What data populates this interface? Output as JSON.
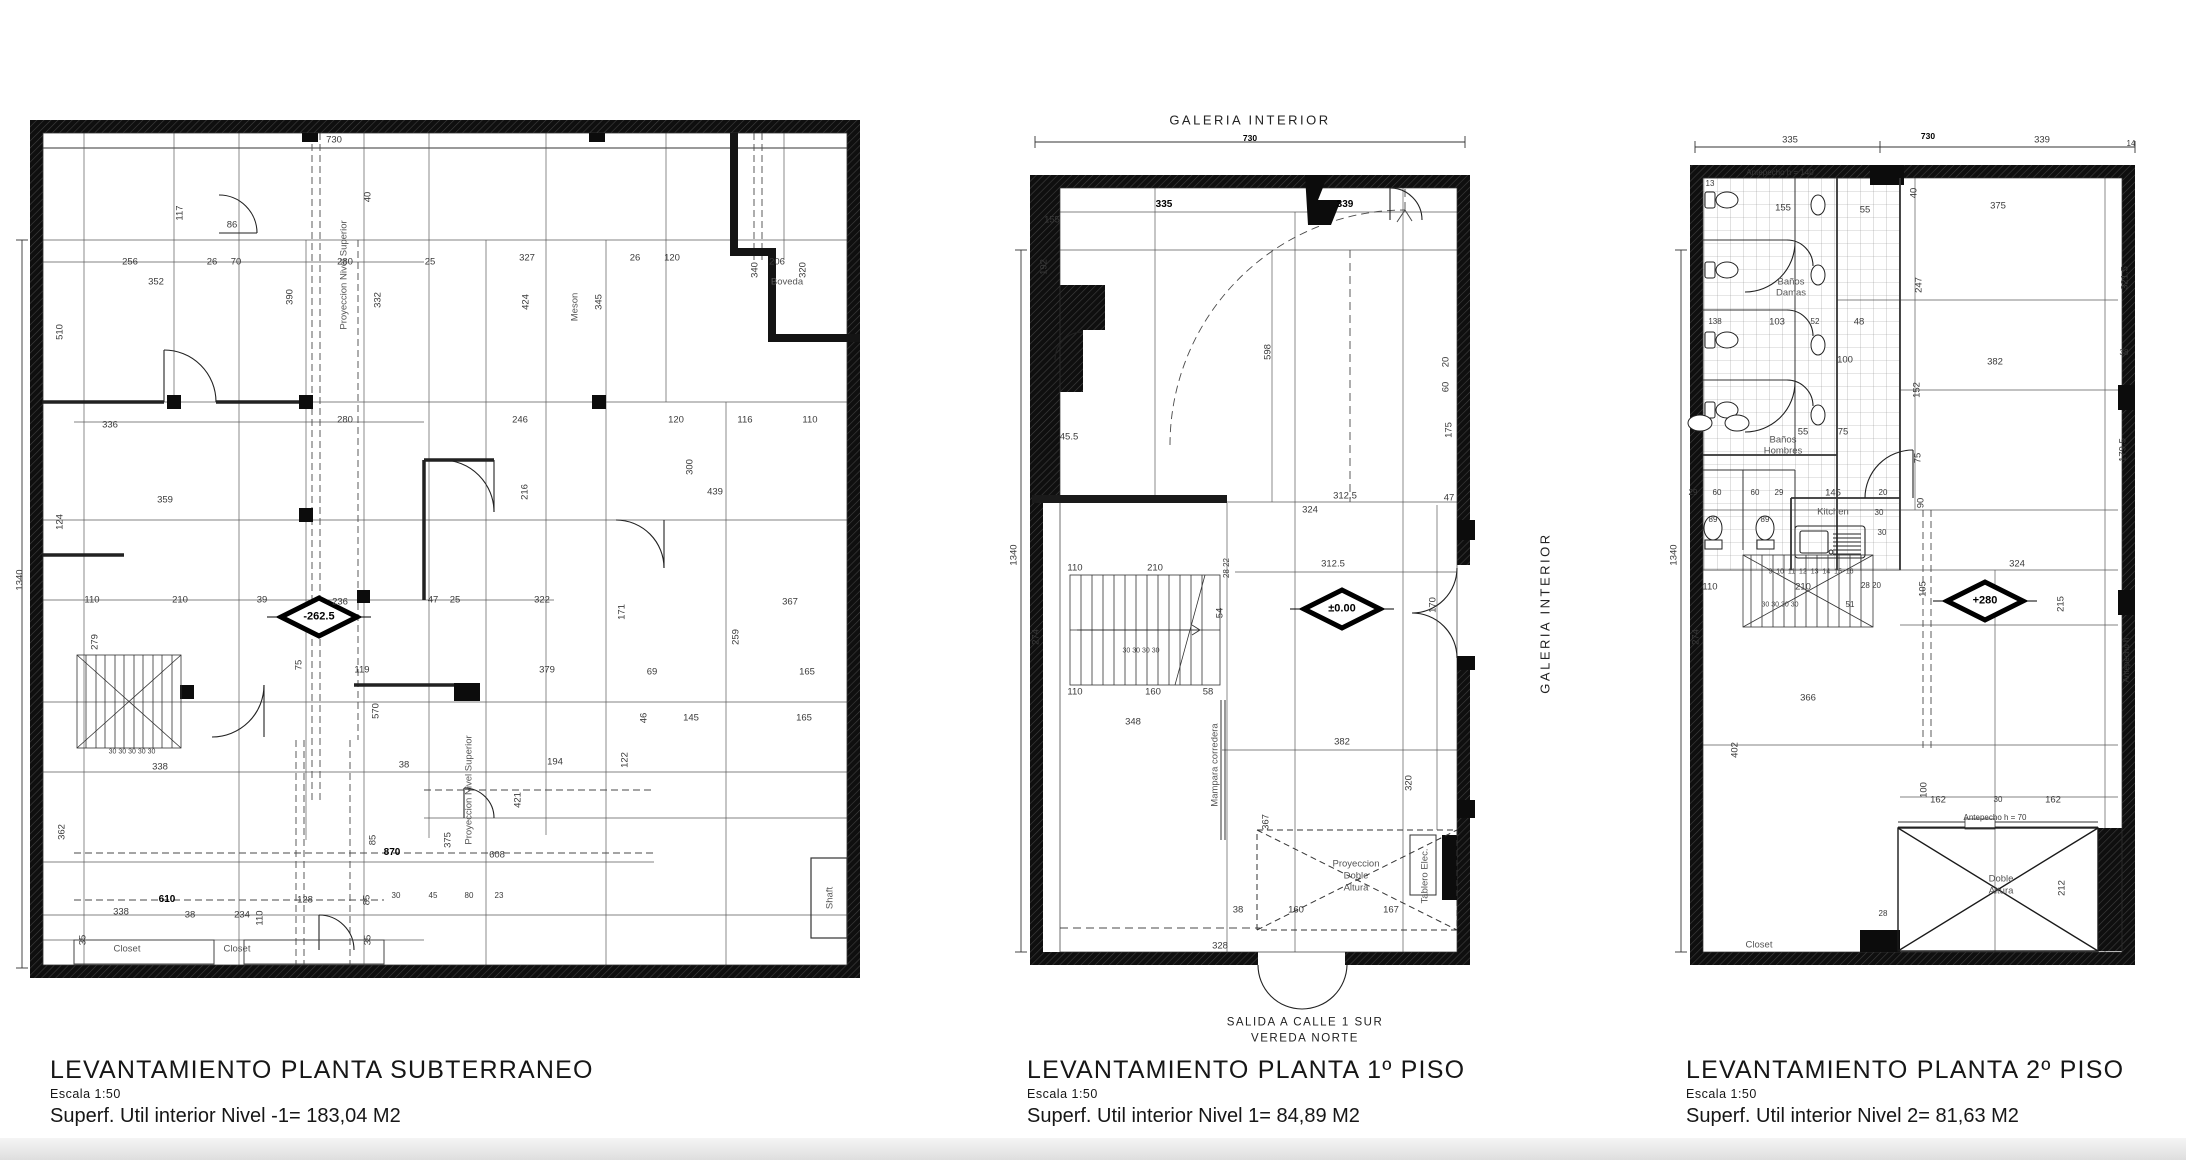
{
  "sheet": {
    "background": "#ffffff",
    "line_color": "#333333",
    "wall_color": "#0f0f0f"
  },
  "plans": [
    {
      "id": "p1",
      "title": "LEVANTAMIENTO PLANTA SUBTERRANEO",
      "scale_label": "Escala 1:50",
      "area_label": "Superf. Util interior Nivel -1= 183,04 M2",
      "level_marker": "-262.5",
      "labels": [
        {
          "t": "730",
          "x": 320,
          "y": 40
        },
        {
          "t": "1340",
          "x": 6,
          "y": 480,
          "r": 1
        },
        {
          "t": "117",
          "x": 166,
          "y": 113,
          "r": 1
        },
        {
          "t": "86",
          "x": 218,
          "y": 125
        },
        {
          "t": "256",
          "x": 116,
          "y": 162
        },
        {
          "t": "26",
          "x": 198,
          "y": 162
        },
        {
          "t": "70",
          "x": 222,
          "y": 162
        },
        {
          "t": "280",
          "x": 331,
          "y": 162
        },
        {
          "t": "25",
          "x": 416,
          "y": 162
        },
        {
          "t": "327",
          "x": 513,
          "y": 158
        },
        {
          "t": "26",
          "x": 621,
          "y": 158
        },
        {
          "t": "120",
          "x": 658,
          "y": 158
        },
        {
          "t": "206",
          "x": 763,
          "y": 162
        },
        {
          "t": "352",
          "x": 142,
          "y": 182
        },
        {
          "t": "Boveda",
          "x": 773,
          "y": 182,
          "c": "room"
        },
        {
          "t": "40",
          "x": 354,
          "y": 97,
          "r": 1
        },
        {
          "t": "390",
          "x": 276,
          "y": 197,
          "r": 1
        },
        {
          "t": "332",
          "x": 364,
          "y": 200,
          "r": 1
        },
        {
          "t": "424",
          "x": 512,
          "y": 202,
          "r": 1
        },
        {
          "t": "Meson",
          "x": 561,
          "y": 207,
          "r": 1,
          "c": "room"
        },
        {
          "t": "345",
          "x": 585,
          "y": 202,
          "r": 1
        },
        {
          "t": "340",
          "x": 741,
          "y": 170,
          "r": 1
        },
        {
          "t": "320",
          "x": 789,
          "y": 170,
          "r": 1
        },
        {
          "t": "510",
          "x": 46,
          "y": 232,
          "r": 1
        },
        {
          "t": "Proyeccion Nivel Superior",
          "x": 330,
          "y": 175,
          "r": 1,
          "c": "room"
        },
        {
          "t": "336",
          "x": 96,
          "y": 325
        },
        {
          "t": "280",
          "x": 331,
          "y": 320
        },
        {
          "t": "246",
          "x": 506,
          "y": 320
        },
        {
          "t": "120",
          "x": 662,
          "y": 320
        },
        {
          "t": "116",
          "x": 731,
          "y": 320
        },
        {
          "t": "110",
          "x": 796,
          "y": 320
        },
        {
          "t": "359",
          "x": 151,
          "y": 400
        },
        {
          "t": "216",
          "x": 511,
          "y": 392,
          "r": 1
        },
        {
          "t": "300",
          "x": 676,
          "y": 367,
          "r": 1
        },
        {
          "t": "439",
          "x": 701,
          "y": 392
        },
        {
          "t": "124",
          "x": 46,
          "y": 422,
          "r": 1
        },
        {
          "t": "110",
          "x": 78,
          "y": 500
        },
        {
          "t": "210",
          "x": 166,
          "y": 500
        },
        {
          "t": "39",
          "x": 248,
          "y": 500
        },
        {
          "t": "236",
          "x": 326,
          "y": 502
        },
        {
          "t": "47",
          "x": 419,
          "y": 500
        },
        {
          "t": "25",
          "x": 441,
          "y": 500
        },
        {
          "t": "322",
          "x": 528,
          "y": 500
        },
        {
          "t": "171",
          "x": 608,
          "y": 512,
          "r": 1
        },
        {
          "t": "367",
          "x": 776,
          "y": 502
        },
        {
          "t": "-262.5",
          "x": 305,
          "y": 517,
          "c": "lvl"
        },
        {
          "t": "279",
          "x": 81,
          "y": 542,
          "r": 1
        },
        {
          "t": "75",
          "x": 285,
          "y": 565,
          "r": 1
        },
        {
          "t": "119",
          "x": 348,
          "y": 570
        },
        {
          "t": "379",
          "x": 533,
          "y": 570
        },
        {
          "t": "69",
          "x": 638,
          "y": 572
        },
        {
          "t": "165",
          "x": 793,
          "y": 572
        },
        {
          "t": "259",
          "x": 722,
          "y": 537,
          "r": 1
        },
        {
          "t": "30 30 30 30 30",
          "x": 118,
          "y": 652,
          "c": "sm"
        },
        {
          "t": "570",
          "x": 362,
          "y": 611,
          "r": 1
        },
        {
          "t": "46",
          "x": 630,
          "y": 618,
          "r": 1
        },
        {
          "t": "145",
          "x": 677,
          "y": 618
        },
        {
          "t": "165",
          "x": 790,
          "y": 618
        },
        {
          "t": "338",
          "x": 146,
          "y": 667
        },
        {
          "t": "38",
          "x": 390,
          "y": 665
        },
        {
          "t": "194",
          "x": 541,
          "y": 662
        },
        {
          "t": "122",
          "x": 611,
          "y": 660,
          "r": 1
        },
        {
          "t": "Proyeccion Nivel Superior",
          "x": 455,
          "y": 690,
          "r": 1,
          "c": "room"
        },
        {
          "t": "362",
          "x": 48,
          "y": 732,
          "r": 1
        },
        {
          "t": "85",
          "x": 359,
          "y": 740,
          "r": 1
        },
        {
          "t": "375",
          "x": 434,
          "y": 740,
          "r": 1
        },
        {
          "t": "870",
          "x": 378,
          "y": 753,
          "c": "b"
        },
        {
          "t": "608",
          "x": 483,
          "y": 755
        },
        {
          "t": "421",
          "x": 504,
          "y": 700,
          "r": 1
        },
        {
          "t": "30",
          "x": 382,
          "y": 796,
          "c": "sm8"
        },
        {
          "t": "45",
          "x": 419,
          "y": 796,
          "c": "sm8"
        },
        {
          "t": "80",
          "x": 455,
          "y": 796,
          "c": "sm8"
        },
        {
          "t": "23",
          "x": 485,
          "y": 796,
          "c": "sm8"
        },
        {
          "t": "610",
          "x": 153,
          "y": 800,
          "c": "b"
        },
        {
          "t": "128",
          "x": 291,
          "y": 800
        },
        {
          "t": "338",
          "x": 107,
          "y": 812
        },
        {
          "t": "38",
          "x": 176,
          "y": 815
        },
        {
          "t": "234",
          "x": 228,
          "y": 815
        },
        {
          "t": "110",
          "x": 246,
          "y": 818,
          "r": 1
        },
        {
          "t": "35",
          "x": 69,
          "y": 840,
          "r": 1
        },
        {
          "t": "85",
          "x": 353,
          "y": 800,
          "r": 1
        },
        {
          "t": "35",
          "x": 354,
          "y": 840,
          "r": 1
        },
        {
          "t": "Closet",
          "x": 113,
          "y": 849,
          "c": "room"
        },
        {
          "t": "Closet",
          "x": 223,
          "y": 849,
          "c": "room"
        },
        {
          "t": "Shaft",
          "x": 816,
          "y": 798,
          "r": 1,
          "c": "room"
        }
      ]
    },
    {
      "id": "p2",
      "title": "LEVANTAMIENTO PLANTA 1º PISO",
      "scale_label": "Escala 1:50",
      "area_label": "Superf. Util interior Nivel 1= 84,89 M2",
      "level_marker": "±0.00",
      "labels": [
        {
          "t": "GALERIA INTERIOR",
          "x": 245,
          "y": 20,
          "c": "big"
        },
        {
          "t": "730",
          "x": 245,
          "y": 38,
          "c": "b2"
        },
        {
          "t": "335",
          "x": 159,
          "y": 105,
          "c": "b"
        },
        {
          "t": "339",
          "x": 340,
          "y": 105,
          "c": "b"
        },
        {
          "t": "155",
          "x": 47,
          "y": 120
        },
        {
          "t": "192",
          "x": 39,
          "y": 167,
          "r": 1
        },
        {
          "t": "598",
          "x": 263,
          "y": 252,
          "r": 1
        },
        {
          "t": "20",
          "x": 441,
          "y": 262,
          "r": 1
        },
        {
          "t": "60",
          "x": 441,
          "y": 287,
          "r": 1
        },
        {
          "t": "175",
          "x": 444,
          "y": 330,
          "r": 1
        },
        {
          "t": "45.5",
          "x": 64,
          "y": 337
        },
        {
          "t": "312.5",
          "x": 340,
          "y": 396
        },
        {
          "t": "324",
          "x": 305,
          "y": 410
        },
        {
          "t": "47",
          "x": 444,
          "y": 398
        },
        {
          "t": "312.5",
          "x": 328,
          "y": 464
        },
        {
          "t": "110",
          "x": 70,
          "y": 468
        },
        {
          "t": "210",
          "x": 150,
          "y": 468
        },
        {
          "t": "28 22",
          "x": 222,
          "y": 468,
          "r": 1,
          "c": "sm8"
        },
        {
          "t": "30 30 30 30",
          "x": 136,
          "y": 551,
          "c": "sm"
        },
        {
          "t": "54",
          "x": 215,
          "y": 513,
          "r": 1
        },
        {
          "t": "±0.00",
          "x": 337,
          "y": 509,
          "c": "lvl"
        },
        {
          "t": "170",
          "x": 428,
          "y": 505,
          "r": 1
        },
        {
          "t": "110",
          "x": 70,
          "y": 592
        },
        {
          "t": "160",
          "x": 148,
          "y": 592
        },
        {
          "t": "58",
          "x": 203,
          "y": 592
        },
        {
          "t": "348",
          "x": 128,
          "y": 622
        },
        {
          "t": "GALERIA INTERIOR",
          "x": 540,
          "y": 513,
          "r": 1,
          "c": "big"
        },
        {
          "t": "Mampara corredera",
          "x": 210,
          "y": 665,
          "r": 1,
          "c": "room"
        },
        {
          "t": "382",
          "x": 337,
          "y": 642
        },
        {
          "t": "320",
          "x": 404,
          "y": 683,
          "r": 1
        },
        {
          "t": "367",
          "x": 261,
          "y": 722,
          "r": 1
        },
        {
          "t": "274",
          "x": 31,
          "y": 537,
          "r": 1
        },
        {
          "t": "1340",
          "x": 9,
          "y": 455,
          "r": 1
        },
        {
          "t": "Proyeccion",
          "x": 351,
          "y": 764,
          "c": "room"
        },
        {
          "t": "Doble",
          "x": 351,
          "y": 776,
          "c": "room"
        },
        {
          "t": "Altura",
          "x": 351,
          "y": 788,
          "c": "room"
        },
        {
          "t": "Tablero Elec.",
          "x": 420,
          "y": 776,
          "r": 1,
          "c": "room"
        },
        {
          "t": "38",
          "x": 233,
          "y": 810
        },
        {
          "t": "160",
          "x": 291,
          "y": 810
        },
        {
          "t": "167",
          "x": 386,
          "y": 810
        },
        {
          "t": "328",
          "x": 215,
          "y": 846
        },
        {
          "t": "SALIDA A CALLE 1 SUR",
          "x": 300,
          "y": 923,
          "c": "big2"
        },
        {
          "t": "VEREDA NORTE",
          "x": 300,
          "y": 939,
          "c": "big2"
        }
      ]
    },
    {
      "id": "p3",
      "title": "LEVANTAMIENTO PLANTA 2º PISO",
      "scale_label": "Escala 1:50",
      "area_label": "Superf. Util interior Nivel 2= 81,63 M2",
      "level_marker": "+280",
      "labels": [
        {
          "t": "335",
          "x": 125,
          "y": 40
        },
        {
          "t": "730",
          "x": 263,
          "y": 36,
          "c": "b2"
        },
        {
          "t": "339",
          "x": 377,
          "y": 40
        },
        {
          "t": "14",
          "x": 466,
          "y": 44,
          "c": "sm8"
        },
        {
          "t": "Antepecho h = 140",
          "x": 115,
          "y": 73,
          "c": "sm8"
        },
        {
          "t": "13",
          "x": 45,
          "y": 84,
          "c": "sm8"
        },
        {
          "t": "155",
          "x": 118,
          "y": 108
        },
        {
          "t": "55",
          "x": 200,
          "y": 110
        },
        {
          "t": "40",
          "x": 249,
          "y": 93,
          "r": 1
        },
        {
          "t": "375",
          "x": 333,
          "y": 106
        },
        {
          "t": "247",
          "x": 254,
          "y": 185,
          "r": 1
        },
        {
          "t": "321.5",
          "x": 460,
          "y": 178,
          "r": 1
        },
        {
          "t": "Baños",
          "x": 126,
          "y": 182,
          "c": "room"
        },
        {
          "t": "Damas",
          "x": 126,
          "y": 193,
          "c": "room"
        },
        {
          "t": "138",
          "x": 50,
          "y": 222,
          "c": "sm8"
        },
        {
          "t": "103",
          "x": 112,
          "y": 222
        },
        {
          "t": "52",
          "x": 150,
          "y": 222,
          "c": "sm8"
        },
        {
          "t": "48",
          "x": 194,
          "y": 222
        },
        {
          "t": "100",
          "x": 180,
          "y": 260
        },
        {
          "t": "152",
          "x": 252,
          "y": 290,
          "r": 1
        },
        {
          "t": "382",
          "x": 330,
          "y": 262
        },
        {
          "t": "38",
          "x": 459,
          "y": 253,
          "c": "sm8"
        },
        {
          "t": "179.5",
          "x": 458,
          "y": 350,
          "r": 1
        },
        {
          "t": "Baños",
          "x": 118,
          "y": 340,
          "c": "room"
        },
        {
          "t": "Hombres",
          "x": 118,
          "y": 351,
          "c": "room"
        },
        {
          "t": "55",
          "x": 138,
          "y": 332
        },
        {
          "t": "75",
          "x": 178,
          "y": 332
        },
        {
          "t": "75",
          "x": 253,
          "y": 358,
          "r": 1
        },
        {
          "t": "29",
          "x": 28,
          "y": 393,
          "c": "sm8"
        },
        {
          "t": "60",
          "x": 52,
          "y": 393,
          "c": "sm8"
        },
        {
          "t": "60",
          "x": 90,
          "y": 393,
          "c": "sm8"
        },
        {
          "t": "29",
          "x": 114,
          "y": 393,
          "c": "sm8"
        },
        {
          "t": "145",
          "x": 168,
          "y": 393
        },
        {
          "t": "20",
          "x": 218,
          "y": 393,
          "c": "sm8"
        },
        {
          "t": "90",
          "x": 256,
          "y": 403,
          "r": 1
        },
        {
          "t": "Kitchen",
          "x": 168,
          "y": 412,
          "c": "room"
        },
        {
          "t": "30",
          "x": 214,
          "y": 413,
          "c": "sm8"
        },
        {
          "t": "30",
          "x": 217,
          "y": 433,
          "c": "sm8"
        },
        {
          "t": "89",
          "x": 48,
          "y": 420,
          "c": "sm8"
        },
        {
          "t": "89",
          "x": 100,
          "y": 420,
          "c": "sm8"
        },
        {
          "t": "9  10  11  12  13  14  15  16",
          "x": 146,
          "y": 472,
          "c": "sm"
        },
        {
          "t": "110",
          "x": 45,
          "y": 487
        },
        {
          "t": "210",
          "x": 138,
          "y": 487
        },
        {
          "t": "28 20",
          "x": 206,
          "y": 486,
          "c": "sm8"
        },
        {
          "t": "30 30 30 30",
          "x": 115,
          "y": 505,
          "c": "sm"
        },
        {
          "t": "51",
          "x": 185,
          "y": 505,
          "c": "sm8"
        },
        {
          "t": "+280",
          "x": 320,
          "y": 501,
          "c": "lvl"
        },
        {
          "t": "324",
          "x": 352,
          "y": 464
        },
        {
          "t": "105",
          "x": 258,
          "y": 489,
          "r": 1
        },
        {
          "t": "215",
          "x": 396,
          "y": 504,
          "r": 1
        },
        {
          "t": "274",
          "x": 31,
          "y": 537,
          "r": 1
        },
        {
          "t": "1340",
          "x": 9,
          "y": 455,
          "r": 1
        },
        {
          "t": "Antepecho h",
          "x": 462,
          "y": 560,
          "r": 1,
          "c": "sm8"
        },
        {
          "t": "366",
          "x": 143,
          "y": 598
        },
        {
          "t": "402",
          "x": 70,
          "y": 650,
          "r": 1
        },
        {
          "t": "100",
          "x": 259,
          "y": 690,
          "r": 1
        },
        {
          "t": "162",
          "x": 273,
          "y": 700
        },
        {
          "t": "30",
          "x": 333,
          "y": 700,
          "c": "sm8"
        },
        {
          "t": "162",
          "x": 388,
          "y": 700
        },
        {
          "t": "Antepecho h = 70",
          "x": 330,
          "y": 718,
          "c": "sm8"
        },
        {
          "t": "Doble",
          "x": 336,
          "y": 779,
          "c": "room"
        },
        {
          "t": "Altura",
          "x": 336,
          "y": 791,
          "c": "room"
        },
        {
          "t": "212",
          "x": 397,
          "y": 788,
          "r": 1
        },
        {
          "t": "28",
          "x": 218,
          "y": 814,
          "c": "sm8"
        },
        {
          "t": "Closet",
          "x": 94,
          "y": 845,
          "c": "room"
        }
      ]
    }
  ]
}
